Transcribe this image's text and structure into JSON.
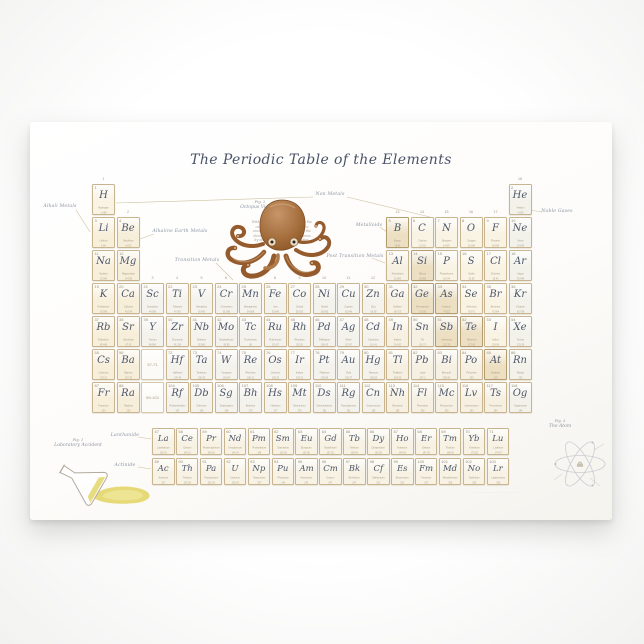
{
  "poster": {
    "title": "The Periodic Table of the Elements",
    "figures": {
      "fig1": {
        "label": "Fig. 1",
        "caption": "Laboratory Accident"
      },
      "fig2": {
        "label": "Fig. 2",
        "caption": "Octopus Vulgaris",
        "paragraph_lines": [
          "With eight arms and three hearts the",
          "curious octopus drifts across the",
          "ancient table, arranging each of the",
          "elements in neat rows and columns",
          "by atomic number and properties."
        ]
      },
      "fig3": {
        "label": "Fig. 3",
        "caption": "The Atom"
      }
    },
    "fine_print": "····· ······· ······ ······· ·····"
  },
  "annotations": [
    {
      "text": "Alkali Metals",
      "x": 30,
      "y": 82,
      "lines": [
        [
          46,
          88,
          60,
          110
        ]
      ]
    },
    {
      "text": "Alkaline Earth Metals",
      "x": 150,
      "y": 107,
      "lines": [
        [
          124,
          112,
          110,
          117
        ]
      ]
    },
    {
      "text": "Transition Metals",
      "x": 167,
      "y": 136,
      "lines": [
        [
          186,
          141,
          203,
          158
        ]
      ]
    },
    {
      "text": "Non Metals",
      "x": 300,
      "y": 70,
      "lines": [
        [
          283,
          75,
          86,
          81
        ],
        [
          317,
          75,
          400,
          95
        ]
      ]
    },
    {
      "text": "Metalloids",
      "x": 339,
      "y": 101,
      "lines": [
        [
          350,
          105,
          357,
          110
        ]
      ]
    },
    {
      "text": "Post Transition Metals",
      "x": 325,
      "y": 132,
      "lines": [
        [
          342,
          136,
          355,
          141
        ]
      ]
    },
    {
      "text": "Noble Gases",
      "x": 527,
      "y": 87,
      "lines": [
        [
          500,
          88,
          512,
          90
        ]
      ]
    },
    {
      "text": "Lanthanide",
      "x": 95,
      "y": 311,
      "lines": [
        [
          108,
          315,
          121,
          317
        ]
      ]
    },
    {
      "text": "Actinide",
      "x": 95,
      "y": 341,
      "lines": [
        [
          108,
          345,
          121,
          347
        ]
      ]
    }
  ],
  "group_numbers": [
    "1",
    "2",
    "3",
    "4",
    "5",
    "6",
    "7",
    "8",
    "9",
    "10",
    "11",
    "12",
    "13",
    "14",
    "15",
    "16",
    "17",
    "18"
  ],
  "placeholders": [
    {
      "text": "57-71",
      "g": 3,
      "p": 6
    },
    {
      "text": "89-103",
      "g": 3,
      "p": 7
    }
  ],
  "colors": {
    "ink": "#4d5668",
    "cell_border": "#c8b590",
    "metalloid_border": "#b39c6e",
    "alkali": "#f8efdb",
    "alkaline_earth": "#f7eed9",
    "transition": "#f4f2ec",
    "post_transition": "#f6f0e2",
    "metalloid": "#ecdfc2",
    "nonmetal": "#f9f3e4",
    "noble_gas": "#f2f2ea",
    "lanthanide": "#f7f2e4",
    "actinide": "#f7f2e4",
    "octopus": "#a26a3e",
    "spilled_liquid": "#e3d669"
  },
  "elements": [
    [
      1,
      "H",
      "Hydrogen",
      "1.008",
      1,
      1,
      "nm"
    ],
    [
      2,
      "He",
      "Helium",
      "4.003",
      18,
      1,
      "ng"
    ],
    [
      3,
      "Li",
      "Lithium",
      "6.94",
      1,
      2,
      "ak"
    ],
    [
      4,
      "Be",
      "Beryllium",
      "9.012",
      2,
      2,
      "ae"
    ],
    [
      5,
      "B",
      "Boron",
      "10.81",
      13,
      2,
      "md"
    ],
    [
      6,
      "C",
      "Carbon",
      "12.011",
      14,
      2,
      "nm"
    ],
    [
      7,
      "N",
      "Nitrogen",
      "14.007",
      15,
      2,
      "nm"
    ],
    [
      8,
      "O",
      "Oxygen",
      "15.999",
      16,
      2,
      "nm"
    ],
    [
      9,
      "F",
      "Fluorine",
      "18.998",
      17,
      2,
      "nm"
    ],
    [
      10,
      "Ne",
      "Neon",
      "20.180",
      18,
      2,
      "ng"
    ],
    [
      11,
      "Na",
      "Sodium",
      "22.990",
      1,
      3,
      "ak"
    ],
    [
      12,
      "Mg",
      "Magnesium",
      "24.305",
      2,
      3,
      "ae"
    ],
    [
      13,
      "Al",
      "Aluminium",
      "26.982",
      13,
      3,
      "pt"
    ],
    [
      14,
      "Si",
      "Silicon",
      "28.085",
      14,
      3,
      "md"
    ],
    [
      15,
      "P",
      "Phosphorus",
      "30.974",
      15,
      3,
      "nm"
    ],
    [
      16,
      "S",
      "Sulfur",
      "32.06",
      16,
      3,
      "nm"
    ],
    [
      17,
      "Cl",
      "Chlorine",
      "35.45",
      17,
      3,
      "nm"
    ],
    [
      18,
      "Ar",
      "Argon",
      "39.948",
      18,
      3,
      "ng"
    ],
    [
      19,
      "K",
      "Potassium",
      "39.098",
      1,
      4,
      "ak"
    ],
    [
      20,
      "Ca",
      "Calcium",
      "40.078",
      2,
      4,
      "ae"
    ],
    [
      21,
      "Sc",
      "Scandium",
      "44.956",
      3,
      4,
      "tm"
    ],
    [
      22,
      "Ti",
      "Titanium",
      "47.867",
      4,
      4,
      "tm"
    ],
    [
      23,
      "V",
      "Vanadium",
      "50.942",
      5,
      4,
      "tm"
    ],
    [
      24,
      "Cr",
      "Chromium",
      "51.996",
      6,
      4,
      "tm"
    ],
    [
      25,
      "Mn",
      "Manganese",
      "54.938",
      7,
      4,
      "tm"
    ],
    [
      26,
      "Fe",
      "Iron",
      "55.845",
      8,
      4,
      "tm"
    ],
    [
      27,
      "Co",
      "Cobalt",
      "58.933",
      9,
      4,
      "tm"
    ],
    [
      28,
      "Ni",
      "Nickel",
      "58.693",
      10,
      4,
      "tm"
    ],
    [
      29,
      "Cu",
      "Copper",
      "63.546",
      11,
      4,
      "tm"
    ],
    [
      30,
      "Zn",
      "Zinc",
      "65.38",
      12,
      4,
      "tm"
    ],
    [
      31,
      "Ga",
      "Gallium",
      "69.723",
      13,
      4,
      "pt"
    ],
    [
      32,
      "Ge",
      "Germanium",
      "72.630",
      14,
      4,
      "md"
    ],
    [
      33,
      "As",
      "Arsenic",
      "74.922",
      15,
      4,
      "md"
    ],
    [
      34,
      "Se",
      "Selenium",
      "78.971",
      16,
      4,
      "nm"
    ],
    [
      35,
      "Br",
      "Bromine",
      "79.904",
      17,
      4,
      "nm"
    ],
    [
      36,
      "Kr",
      "Krypton",
      "83.798",
      18,
      4,
      "ng"
    ],
    [
      37,
      "Rb",
      "Rubidium",
      "85.468",
      1,
      5,
      "ak"
    ],
    [
      38,
      "Sr",
      "Strontium",
      "87.62",
      2,
      5,
      "ae"
    ],
    [
      39,
      "Y",
      "Yttrium",
      "88.906",
      3,
      5,
      "tm"
    ],
    [
      40,
      "Zr",
      "Zirconium",
      "91.224",
      4,
      5,
      "tm"
    ],
    [
      41,
      "Nb",
      "Niobium",
      "92.906",
      5,
      5,
      "tm"
    ],
    [
      42,
      "Mo",
      "Molybdenum",
      "95.95",
      6,
      5,
      "tm"
    ],
    [
      43,
      "Tc",
      "Technetium",
      "98",
      7,
      5,
      "tm"
    ],
    [
      44,
      "Ru",
      "Ruthenium",
      "101.07",
      8,
      5,
      "tm"
    ],
    [
      45,
      "Rh",
      "Rhodium",
      "102.91",
      9,
      5,
      "tm"
    ],
    [
      46,
      "Pd",
      "Palladium",
      "106.42",
      10,
      5,
      "tm"
    ],
    [
      47,
      "Ag",
      "Silver",
      "107.87",
      11,
      5,
      "tm"
    ],
    [
      48,
      "Cd",
      "Cadmium",
      "112.41",
      12,
      5,
      "tm"
    ],
    [
      49,
      "In",
      "Indium",
      "114.82",
      13,
      5,
      "pt"
    ],
    [
      50,
      "Sn",
      "Tin",
      "118.71",
      14,
      5,
      "pt"
    ],
    [
      51,
      "Sb",
      "Antimony",
      "121.76",
      15,
      5,
      "md"
    ],
    [
      52,
      "Te",
      "Tellurium",
      "127.60",
      16,
      5,
      "md"
    ],
    [
      53,
      "I",
      "Iodine",
      "126.90",
      17,
      5,
      "nm"
    ],
    [
      54,
      "Xe",
      "Xenon",
      "131.29",
      18,
      5,
      "ng"
    ],
    [
      55,
      "Cs",
      "Caesium",
      "132.91",
      1,
      6,
      "ak"
    ],
    [
      56,
      "Ba",
      "Barium",
      "137.33",
      2,
      6,
      "ae"
    ],
    [
      72,
      "Hf",
      "Hafnium",
      "178.49",
      4,
      6,
      "tm"
    ],
    [
      73,
      "Ta",
      "Tantalum",
      "180.95",
      5,
      6,
      "tm"
    ],
    [
      74,
      "W",
      "Tungsten",
      "183.84",
      6,
      6,
      "tm"
    ],
    [
      75,
      "Re",
      "Rhenium",
      "186.21",
      7,
      6,
      "tm"
    ],
    [
      76,
      "Os",
      "Osmium",
      "190.23",
      8,
      6,
      "tm"
    ],
    [
      77,
      "Ir",
      "Iridium",
      "192.22",
      9,
      6,
      "tm"
    ],
    [
      78,
      "Pt",
      "Platinum",
      "195.08",
      10,
      6,
      "tm"
    ],
    [
      79,
      "Au",
      "Gold",
      "196.97",
      11,
      6,
      "tm"
    ],
    [
      80,
      "Hg",
      "Mercury",
      "200.59",
      12,
      6,
      "tm"
    ],
    [
      81,
      "Tl",
      "Thallium",
      "204.38",
      13,
      6,
      "pt"
    ],
    [
      82,
      "Pb",
      "Lead",
      "207.2",
      14,
      6,
      "pt"
    ],
    [
      83,
      "Bi",
      "Bismuth",
      "208.98",
      15,
      6,
      "pt"
    ],
    [
      84,
      "Po",
      "Polonium",
      "209",
      16,
      6,
      "pt"
    ],
    [
      85,
      "At",
      "Astatine",
      "210",
      17,
      6,
      "md"
    ],
    [
      86,
      "Rn",
      "Radon",
      "222",
      18,
      6,
      "ng"
    ],
    [
      87,
      "Fr",
      "Francium",
      "223",
      1,
      7,
      "ak"
    ],
    [
      88,
      "Ra",
      "Radium",
      "226",
      2,
      7,
      "ae"
    ],
    [
      104,
      "Rf",
      "Rutherfordium",
      "267",
      4,
      7,
      "tm"
    ],
    [
      105,
      "Db",
      "Dubnium",
      "268",
      5,
      7,
      "tm"
    ],
    [
      106,
      "Sg",
      "Seaborgium",
      "269",
      6,
      7,
      "tm"
    ],
    [
      107,
      "Bh",
      "Bohrium",
      "270",
      7,
      7,
      "tm"
    ],
    [
      108,
      "Hs",
      "Hassium",
      "277",
      8,
      7,
      "tm"
    ],
    [
      109,
      "Mt",
      "Meitnerium",
      "278",
      9,
      7,
      "tm"
    ],
    [
      110,
      "Ds",
      "Darmstadtium",
      "281",
      10,
      7,
      "tm"
    ],
    [
      111,
      "Rg",
      "Roentgenium",
      "282",
      11,
      7,
      "tm"
    ],
    [
      112,
      "Cn",
      "Copernicium",
      "285",
      12,
      7,
      "tm"
    ],
    [
      113,
      "Nh",
      "Nihonium",
      "286",
      13,
      7,
      "pt"
    ],
    [
      114,
      "Fl",
      "Flerovium",
      "289",
      14,
      7,
      "pt"
    ],
    [
      115,
      "Mc",
      "Moscovium",
      "290",
      15,
      7,
      "pt"
    ],
    [
      116,
      "Lv",
      "Livermorium",
      "293",
      16,
      7,
      "pt"
    ],
    [
      117,
      "Ts",
      "Tennessine",
      "294",
      17,
      7,
      "pt"
    ],
    [
      118,
      "Og",
      "Oganesson",
      "294",
      18,
      7,
      "ng"
    ],
    [
      57,
      "La",
      "Lanthanum",
      "138.91",
      1,
      "L",
      "la"
    ],
    [
      58,
      "Ce",
      "Cerium",
      "140.12",
      2,
      "L",
      "la"
    ],
    [
      59,
      "Pr",
      "Praseodymium",
      "140.91",
      3,
      "L",
      "la"
    ],
    [
      60,
      "Nd",
      "Neodymium",
      "144.24",
      4,
      "L",
      "la"
    ],
    [
      61,
      "Pm",
      "Promethium",
      "145",
      5,
      "L",
      "la"
    ],
    [
      62,
      "Sm",
      "Samarium",
      "150.36",
      6,
      "L",
      "la"
    ],
    [
      63,
      "Eu",
      "Europium",
      "151.96",
      7,
      "L",
      "la"
    ],
    [
      64,
      "Gd",
      "Gadolinium",
      "157.25",
      8,
      "L",
      "la"
    ],
    [
      65,
      "Tb",
      "Terbium",
      "158.93",
      9,
      "L",
      "la"
    ],
    [
      66,
      "Dy",
      "Dysprosium",
      "162.50",
      10,
      "L",
      "la"
    ],
    [
      67,
      "Ho",
      "Holmium",
      "164.93",
      11,
      "L",
      "la"
    ],
    [
      68,
      "Er",
      "Erbium",
      "167.26",
      12,
      "L",
      "la"
    ],
    [
      69,
      "Tm",
      "Thulium",
      "168.93",
      13,
      "L",
      "la"
    ],
    [
      70,
      "Yb",
      "Ytterbium",
      "173.05",
      14,
      "L",
      "la"
    ],
    [
      71,
      "Lu",
      "Lutetium",
      "174.97",
      15,
      "L",
      "la"
    ],
    [
      89,
      "Ac",
      "Actinium",
      "227",
      1,
      "A",
      "ac"
    ],
    [
      90,
      "Th",
      "Thorium",
      "232.04",
      2,
      "A",
      "ac"
    ],
    [
      91,
      "Pa",
      "Protactinium",
      "231.04",
      3,
      "A",
      "ac"
    ],
    [
      92,
      "U",
      "Uranium",
      "238.03",
      4,
      "A",
      "ac"
    ],
    [
      93,
      "Np",
      "Neptunium",
      "237",
      5,
      "A",
      "ac"
    ],
    [
      94,
      "Pu",
      "Plutonium",
      "244",
      6,
      "A",
      "ac"
    ],
    [
      95,
      "Am",
      "Americium",
      "243",
      7,
      "A",
      "ac"
    ],
    [
      96,
      "Cm",
      "Curium",
      "247",
      8,
      "A",
      "ac"
    ],
    [
      97,
      "Bk",
      "Berkelium",
      "247",
      9,
      "A",
      "ac"
    ],
    [
      98,
      "Cf",
      "Californium",
      "251",
      10,
      "A",
      "ac"
    ],
    [
      99,
      "Es",
      "Einsteinium",
      "252",
      11,
      "A",
      "ac"
    ],
    [
      100,
      "Fm",
      "Fermium",
      "257",
      12,
      "A",
      "ac"
    ],
    [
      101,
      "Md",
      "Mendelevium",
      "258",
      13,
      "A",
      "ac"
    ],
    [
      102,
      "No",
      "Nobelium",
      "259",
      14,
      "A",
      "ac"
    ],
    [
      103,
      "Lr",
      "Lawrencium",
      "266",
      15,
      "A",
      "ac"
    ]
  ]
}
